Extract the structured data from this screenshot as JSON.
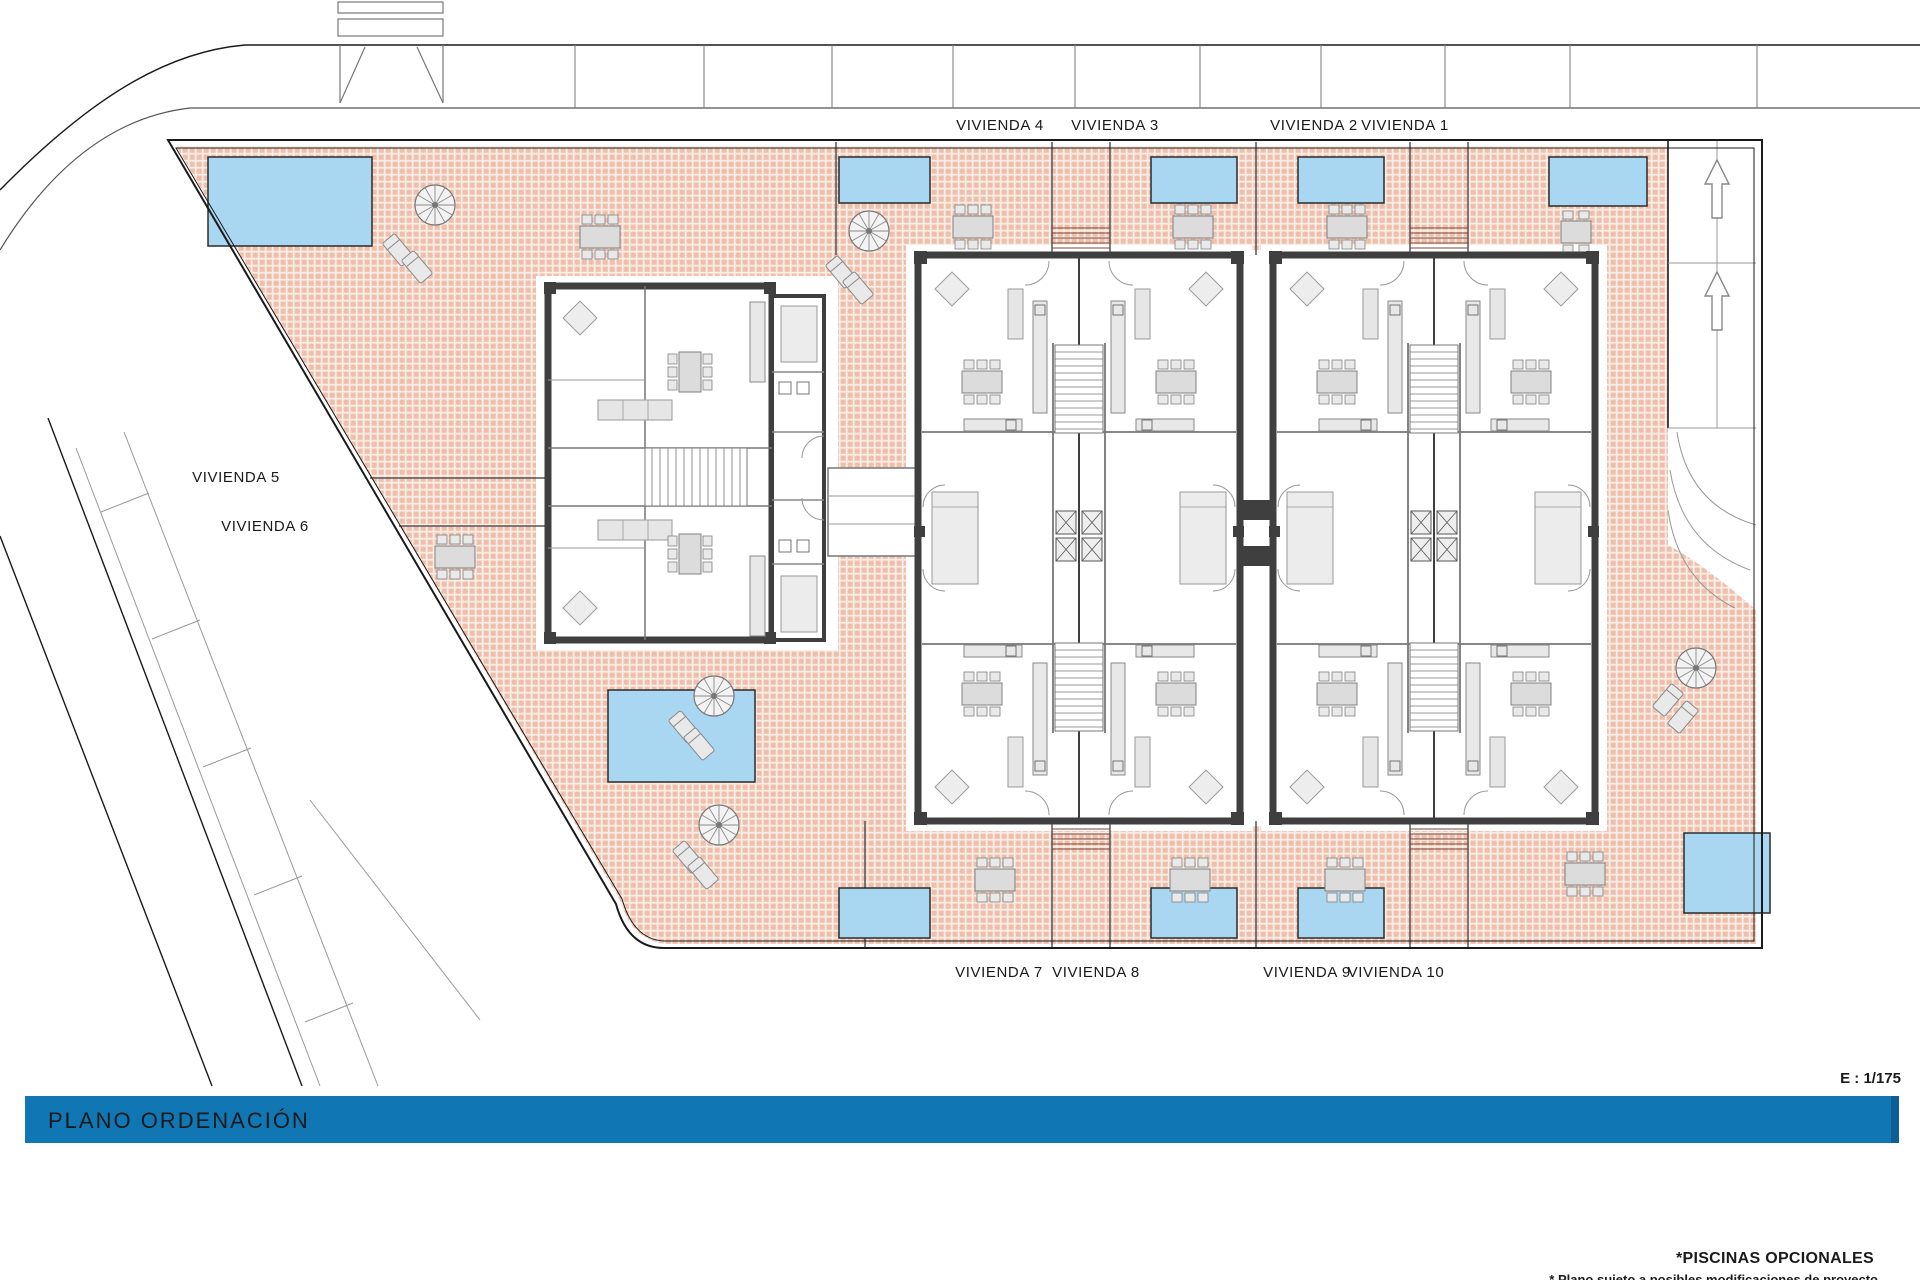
{
  "labels": {
    "viviendas_top": [
      "VIVIENDA 4",
      "VIVIENDA 3",
      "VIVIENDA 2",
      "VIVIENDA 1"
    ],
    "viviendas_left": [
      "VIVIENDA 5",
      "VIVIENDA 6"
    ],
    "viviendas_bottom": [
      "VIVIENDA 7",
      "VIVIENDA 8",
      "VIVIENDA 9",
      "VIVIENDA 10"
    ]
  },
  "title_bar": {
    "label": "PLANO ORDENACIÓN",
    "background": "#1076B4",
    "edge_color": "#0C5E93",
    "text_color": "#15395B"
  },
  "scale": {
    "label": "E : 1/175"
  },
  "footnotes": {
    "piscinas": "*PISCINAS OPCIONALES",
    "modificaciones": "* Plano sujeto a posibles modificaciones de proyecto"
  },
  "colors": {
    "pool": "#A9D6F1",
    "terrace_tile": "#ECB9A2",
    "terrace_bg": "#FAEDE6",
    "wall": "#3F3F3F",
    "thin_line": "#777777",
    "road_line": "#1a1a1a"
  }
}
